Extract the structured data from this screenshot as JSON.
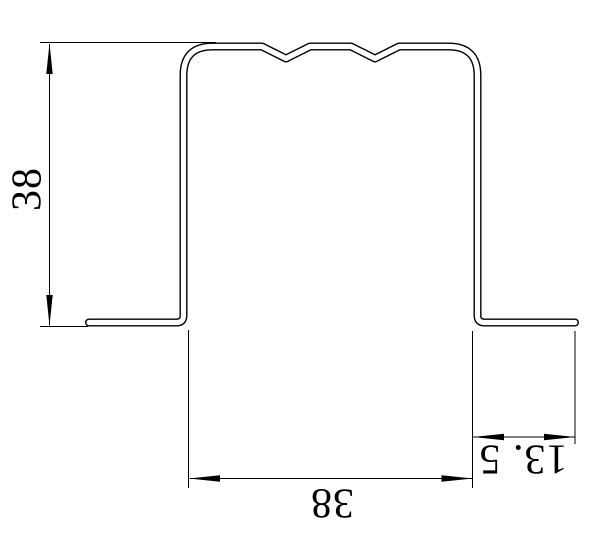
{
  "drawing": {
    "kind": "cad-technical-drawing",
    "subject": "hat-channel-profile-cross-section",
    "features": "double-line sheet outline, two v-notch ribs on top face, outward bottom flanges",
    "colors": {
      "background": "#ffffff",
      "line": "#000000",
      "text": "#000000"
    },
    "dimensions": [
      {
        "id": "height",
        "value": "38",
        "position": "left",
        "orientation": "vertical",
        "text_rotation_deg": -90
      },
      {
        "id": "width",
        "value": "38",
        "position": "bottom",
        "orientation": "horizontal",
        "text_rotation_deg": 180
      },
      {
        "id": "flange_width",
        "value": "13. 5",
        "position": "bottom-right",
        "orientation": "horizontal",
        "text_rotation_deg": 180
      }
    ]
  }
}
